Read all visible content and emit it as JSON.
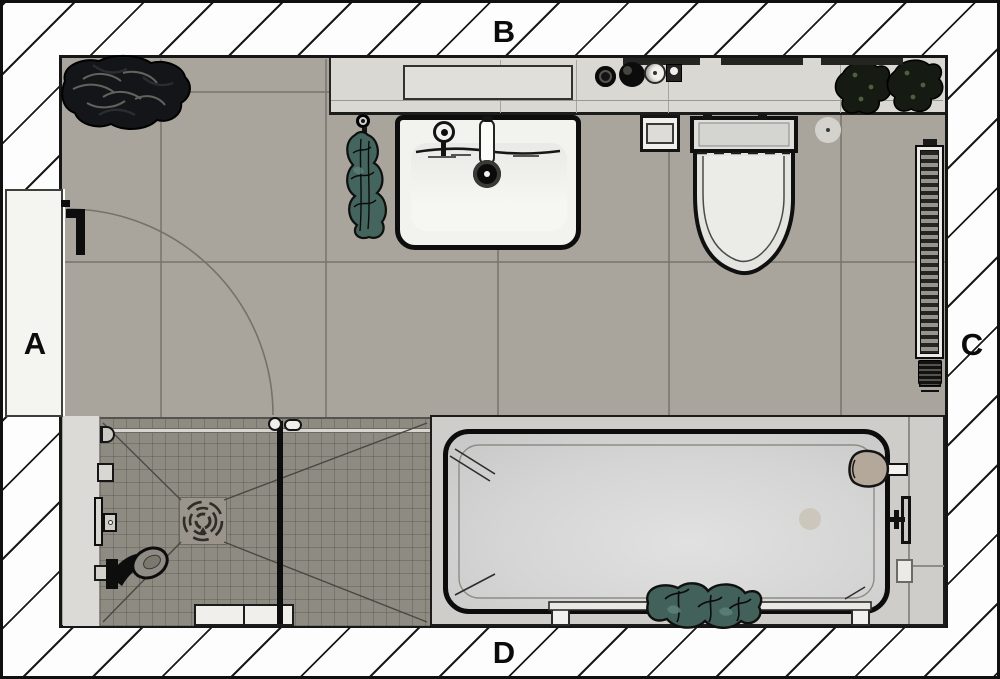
{
  "image": {
    "description": "Top-down architectural floor plan of a bathroom, rendered view",
    "width_px": 1000,
    "height_px": 679
  },
  "labels": {
    "a": "A",
    "b": "B",
    "c": "C",
    "d": "D"
  },
  "wall_labels": [
    {
      "id": "A",
      "side": "left",
      "on": "entry-door"
    },
    {
      "id": "B",
      "side": "top"
    },
    {
      "id": "C",
      "side": "right"
    },
    {
      "id": "D",
      "side": "bottom"
    }
  ],
  "fixtures": [
    "entry-door with quarter-circle swing arc (left wall)",
    "vanity counter with recessed tray and accessories (top wall)",
    "washbasin with faucet and drain",
    "hanging green towel beside washbasin",
    "toilet-paper holder",
    "wall-hung toilet with cistern",
    "round flush plate / drain beside toilet",
    "two potted plants on counter (top right)",
    "large plant (top left corner)",
    "vertical towel radiator with thermostatic valve (right wall)",
    "walk-in shower: wall panel with valves and hand shower, square floor drain with slope lines, glass partition, bottom bench rail",
    "bathtub with inner basin, designer faucet, deck mixer, soap dish, towel rail and draped green towel"
  ],
  "colors": {
    "wall_hatch_bg": "#fdfdfd",
    "wall_hatch_line": "#1a1a1a",
    "floor_main": "#a9a59d",
    "floor_shower": "#8e8b82",
    "counter": "#d9d8d3",
    "fixture_white": "#f2f2ef",
    "tub_deck": "#cecdc9",
    "towel_green": "#44655d",
    "plant_dark": "#15171a",
    "outline_black": "#0d0d0d"
  }
}
